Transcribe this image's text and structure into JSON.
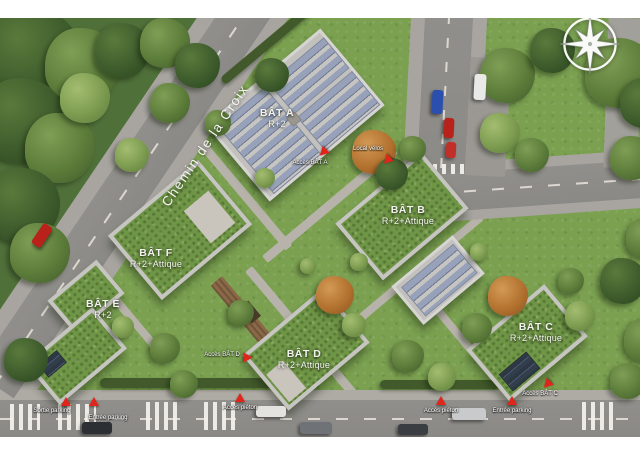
{
  "plan": {
    "street": {
      "name": "Chemin de la Croix"
    },
    "buildings": [
      {
        "id": "bat-a",
        "name": "BÂT A",
        "floors": "R+2"
      },
      {
        "id": "bat-b",
        "name": "BÂT B",
        "floors": "R+2+Attique"
      },
      {
        "id": "bat-c",
        "name": "BÂT C",
        "floors": "R+2+Attique"
      },
      {
        "id": "bat-d",
        "name": "BÂT D",
        "floors": "R+2+Attique"
      },
      {
        "id": "bat-e",
        "name": "BÂT E",
        "floors": "R+2"
      },
      {
        "id": "bat-f",
        "name": "BÂT F",
        "floors": "R+2+Attique"
      }
    ],
    "markers": [
      {
        "label": "Accès BÂT A"
      },
      {
        "label": "Local vélos"
      },
      {
        "label": "Accès BÂT D"
      },
      {
        "label": "Accès BÂT C"
      },
      {
        "label": "Sortie parking"
      },
      {
        "label": "Entrée parking"
      },
      {
        "label": "Accès piéton"
      },
      {
        "label": "Accès piéton"
      },
      {
        "label": "Entrée parking"
      }
    ],
    "compass": {
      "icon": "compass-rose"
    },
    "colors": {
      "marker_red": "#e0261b",
      "grass": "#7aa050",
      "forest": "#50703a",
      "road_asphalt": "#8f8e8a",
      "sidewalk": "#a8a5a0",
      "green_roof": "#6f9546",
      "roof_parapet": "#c6c5c1",
      "solar_panel": "#97a2ba",
      "label_text": "#f3f3ee"
    }
  }
}
